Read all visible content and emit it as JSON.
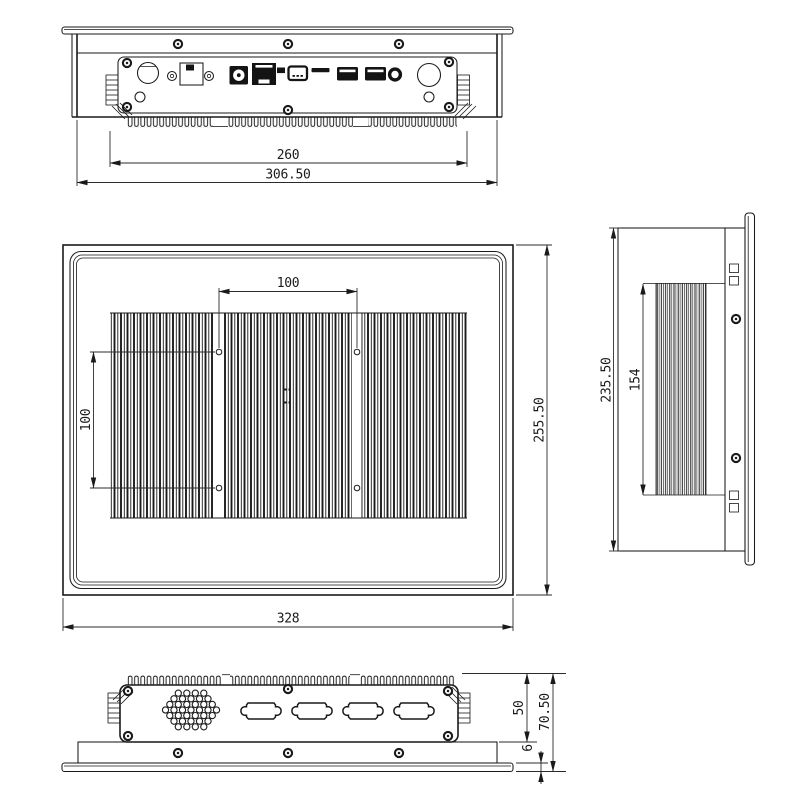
{
  "colors": {
    "background": "#ffffff",
    "line": "#1a1a1a",
    "dimension_line": "#2b2b2b",
    "port_fill": "#141414"
  },
  "dims": {
    "top_fins_width": "260",
    "top_overall_width": "306.50",
    "vesa_horizontal": "100",
    "vesa_vertical": "100",
    "rear_height": "255.50",
    "rear_width": "328",
    "side_height": "235.50",
    "side_fin_height": "154",
    "bottom_body_height": "50",
    "bottom_overall_height": "70.50",
    "bottom_bezel_thickness": "6"
  }
}
